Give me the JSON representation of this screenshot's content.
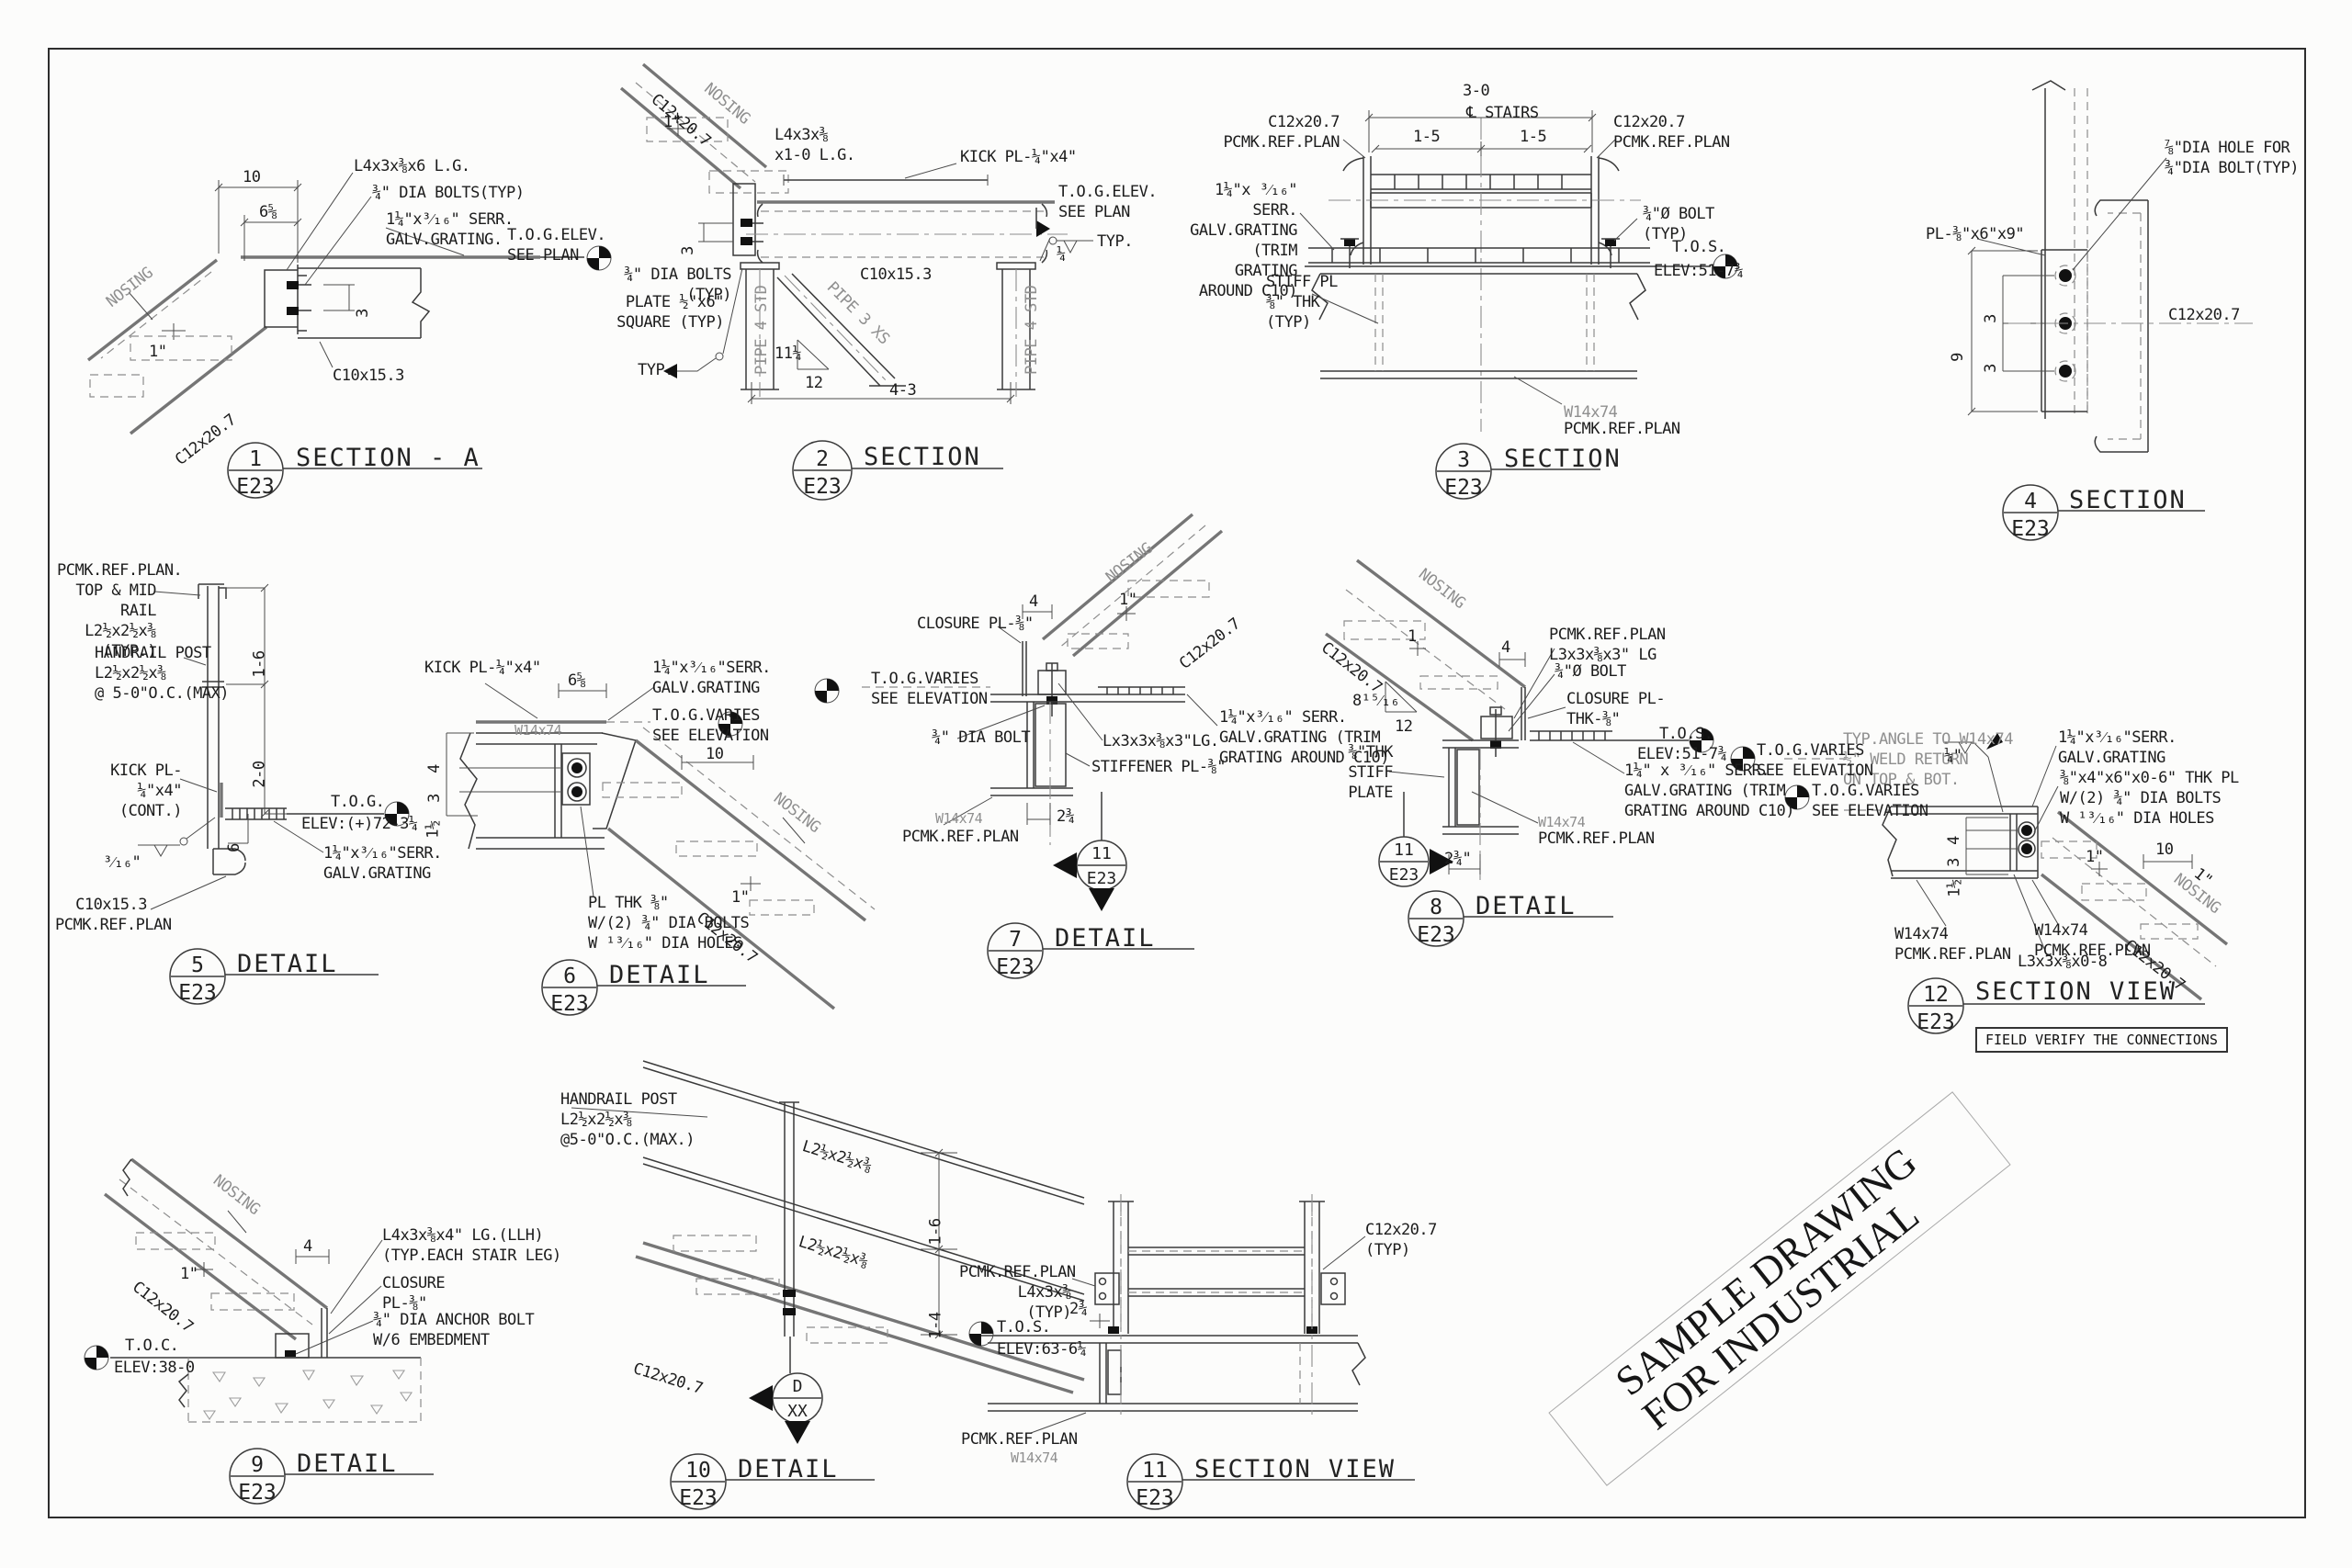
{
  "sheet": {
    "stamp": "SAMPLE DRAWING\nFOR INDUSTRIAL"
  },
  "d1": {
    "num": "1",
    "sht": "E23",
    "title": "SECTION - A",
    "angle": "L4x3x⅜x6 L.G.",
    "bolts": "¾\" DIA BOLTS(TYP)",
    "grating": "1¼\"x³⁄₁₆\" SERR.\nGALV.GRATING.",
    "tog": "T.O.G.ELEV.\nSEE PLAN",
    "c10": "C10x15.3",
    "c12": "C12x20.7",
    "nosing": "NOSING",
    "dim10": "10",
    "dim658": "6⅝",
    "dim3": "3",
    "dim1": "1\""
  },
  "d2": {
    "num": "2",
    "sht": "E23",
    "title": "SECTION",
    "angle": "L4x3x⅜\nx1-0 L.G.",
    "kick": "KICK PL-¼\"x4\"",
    "tog": "T.O.G.ELEV.\nSEE PLAN",
    "bolts": "¾\" DIA BOLTS (TYP)",
    "plate": "PLATE ½\"x6\"\nSQUARE (TYP)",
    "c10": "C10x15.3",
    "c12": "C12x20.7",
    "nosing": "NOSING",
    "dim1": "1\"",
    "dim3": "3",
    "slope_rise": "11¼",
    "slope_run": "12",
    "weld": "¼",
    "weldtyp": "TYP.",
    "pipe_l": "PIPE 4 STD",
    "pipe_r": "PIPE 4 STD",
    "brace": "PIPE 3 XS",
    "dim43": "4-3"
  },
  "d3": {
    "num": "3",
    "sht": "E23",
    "title": "SECTION",
    "dim30": "3-0",
    "stairs": "℄ STAIRS",
    "dim15a": "1-5",
    "dim15b": "1-5",
    "c12l": "C12x20.7\nPCMK.REF.PLAN",
    "c12r": "C12x20.7\nPCMK.REF.PLAN",
    "grating": "1¼\"x ³⁄₁₆\" SERR.\nGALV.GRATING (TRIM\nGRATING AROUND C10)",
    "bolt": "¾\"Ø BOLT\n(TYP)",
    "stiff": "STIFF PL\n⅜\" THK\n(TYP)",
    "tos": "T.O.S.",
    "elev": "ELEV:51-7¾",
    "w14": "W14x74",
    "pcmk": "PCMK.REF.PLAN"
  },
  "d4": {
    "num": "4",
    "sht": "E23",
    "title": "SECTION",
    "hole": "⅞\"DIA HOLE FOR\n¾\"DIA BOLT(TYP)",
    "pl": "PL-⅜\"x6\"x9\"",
    "c12": "C12x20.7",
    "dim9": "9",
    "dim3a": "3",
    "dim3b": "3"
  },
  "d5": {
    "num": "5",
    "sht": "E23",
    "title": "DETAIL",
    "rail": "PCMK.REF.PLAN.\nTOP & MID RAIL\nL2½x2½x⅜\n(TYP.)",
    "post": "HANDRAIL POST\nL2½x2½x⅜\n@ 5-0\"O.C.(MAX)",
    "kick": "KICK PL-\n¼\"x4\"(CONT.)",
    "tog": "T.O.G.",
    "elev": "ELEV:(+)72-3¼",
    "grating": "1¼\"x³⁄₁₆\"SERR.\nGALV.GRATING",
    "c10": "C10x15.3\nPCMK.REF.PLAN",
    "dim16": "1-6",
    "dim20": "2-0",
    "dim6": "6",
    "weld": "³⁄₁₆\""
  },
  "d6": {
    "num": "6",
    "sht": "E23",
    "title": "DETAIL",
    "kick": "KICK PL-¼\"x4\"",
    "dim658": "6⅝",
    "grating": "1¼\"x³⁄₁₆\"SERR.\nGALV.GRATING",
    "tog": "T.O.G.VARIES\nSEE ELEVATION",
    "w14": "W14x74",
    "nosing": "NOSING",
    "c12": "C12x20.7",
    "pl": "PL THK ⅜\"\nW/(2) ¾\" DIA BOLTS\nW ¹³⁄₁₆\" DIA HOLES",
    "dim4": "4",
    "dim3": "3",
    "dim112": "1½",
    "dim10": "10",
    "dim1": "1\""
  },
  "d7": {
    "num": "7",
    "sht": "E23",
    "title": "DETAIL",
    "closure": "CLOSURE PL-⅜\"",
    "tog": "T.O.G.VARIES\nSEE ELEVATION",
    "bolt": "¾\" DIA BOLT",
    "angle": "Lx3x3x⅜x3\"LG.",
    "stiffener": "STIFFENER PL-⅜\"",
    "w14": "W14x74",
    "pcmk": "PCMK.REF.PLAN",
    "grating": "1¼\"x³⁄₁₆\" SERR.\nGALV.GRATING (TRIM\nGRATING AROUND C10)",
    "c12": "C12x20.7",
    "nosing": "NOSING",
    "dim4": "4",
    "dim1": "1\"",
    "dim234": "2¾",
    "mnum": "11",
    "msht": "E23"
  },
  "d8": {
    "num": "8",
    "sht": "E23",
    "title": "DETAIL",
    "c12": "C12x20.7",
    "nosing": "NOSING",
    "dim1": "1",
    "dim4": "4",
    "slope_rise": "8¹⁵⁄₁₆",
    "slope_run": "12",
    "pcmk": "PCMK.REF.PLAN\nL3x3x⅜x3\" LG",
    "bolt": "¾\"Ø BOLT",
    "closure": "CLOSURE PL-\nTHK-⅜\"",
    "stiff": "⅜\"THK\nSTIFF PLATE",
    "tos": "T.O.S.",
    "elev": "ELEV:51-7¾",
    "grating": "1¼\" x ³⁄₁₆\" SERR.\nGALV.GRATING (TRIM\nGRATING AROUND C10)",
    "w14": "W14x74",
    "pcmk2": "PCMK.REF.PLAN",
    "dim234": "2¾\"",
    "mnum": "11",
    "msht": "E23"
  },
  "d9": {
    "num": "9",
    "sht": "E23",
    "title": "DETAIL",
    "nosing": "NOSING",
    "dim1": "1\"",
    "dim4": "4",
    "angle": "L4x3x⅜x4\" LG.(LLH)\n(TYP.EACH STAIR LEG)",
    "closure": "CLOSURE\nPL-⅜\"",
    "anchor": "¾\" DIA ANCHOR BOLT\nW/6 EMBEDMENT",
    "toc": "T.O.C.",
    "elev": "ELEV:38-0",
    "c12": "C12x20.7"
  },
  "d10": {
    "num": "10",
    "sht": "E23",
    "title": "DETAIL",
    "post": "HANDRAIL POST\nL2½x2½x⅜\n@5-0\"O.C.(MAX.)",
    "rail_a": "L2½x2½x⅜",
    "rail_b": "L2½x2½x⅜",
    "dim16": "1-6",
    "dim14": "1-4",
    "c12": "C12x20.7",
    "mnum": "D",
    "msht": "XX"
  },
  "d11": {
    "num": "11",
    "sht": "E23",
    "title": "SECTION VIEW",
    "c12": "C12x20.7\n(TYP)",
    "pcmk": "PCMK.REF.PLAN\nL4x3x⅜\n(TYP)",
    "dim234": "2¾",
    "tos": "T.O.S.",
    "elev": "ELEV:63-6¼",
    "pcmk2": "PCMK.REF.PLAN",
    "w14": "W14x74"
  },
  "d12": {
    "num": "12",
    "sht": "E23",
    "title": "SECTION VIEW",
    "note": "FIELD VERIFY THE CONNECTIONS",
    "typ": "TYP.ANGLE TO W14x74\n½\" WELD RETURN\nON TOP & BOT.",
    "weld": "¼\"",
    "grating": "1¼\"x³⁄₁₆\"SERR.\nGALV.GRATING",
    "pl": "⅜\"x4\"x6\"x0-6\" THK PL\nW/(2) ¾\" DIA BOLTS\nW ¹³⁄₁₆\" DIA HOLES",
    "toga": "T.O.G.VARIES\nSEE ELEVATION",
    "togb": "T.O.G.VARIES\nSEE ELEVATION",
    "dim4": "4",
    "dim3": "3",
    "dim112": "1½",
    "dim10": "10",
    "dim1a": "1\"",
    "dim1b": "1\"",
    "nosing": "NOSING",
    "w14l": "W14x74\nPCMK.REF.PLAN",
    "w14r": "W14x74\nPCMK.REF.PLAN",
    "l3": "L3x3x⅜x0-8",
    "c12": "C12x20.7"
  }
}
